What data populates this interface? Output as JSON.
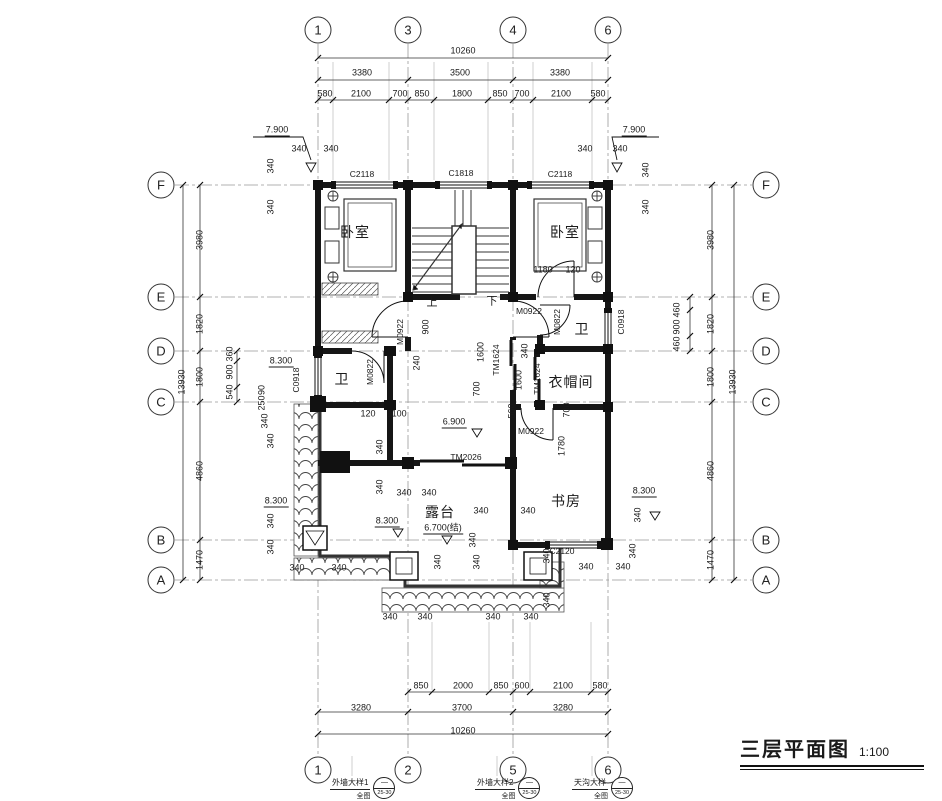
{
  "title": {
    "name": "三层平面图",
    "scale": "1:100"
  },
  "bubbles": {
    "top": [
      {
        "n": "1",
        "x": 318
      },
      {
        "n": "3",
        "x": 408
      },
      {
        "n": "4",
        "x": 513
      },
      {
        "n": "6",
        "x": 608
      }
    ],
    "bottom": [
      {
        "n": "1",
        "x": 318
      },
      {
        "n": "2",
        "x": 408
      },
      {
        "n": "5",
        "x": 513
      },
      {
        "n": "6",
        "x": 608
      }
    ],
    "left": [
      {
        "n": "F",
        "y": 185
      },
      {
        "n": "E",
        "y": 297
      },
      {
        "n": "D",
        "y": 351
      },
      {
        "n": "C",
        "y": 402
      },
      {
        "n": "B",
        "y": 540
      },
      {
        "n": "A",
        "y": 580
      }
    ],
    "right": [
      {
        "n": "F",
        "y": 185
      },
      {
        "n": "E",
        "y": 297
      },
      {
        "n": "D",
        "y": 351
      },
      {
        "n": "C",
        "y": 402
      },
      {
        "n": "B",
        "y": 540
      },
      {
        "n": "A",
        "y": 580
      }
    ]
  },
  "callouts": [
    {
      "label": "外墙大样1",
      "sub": "全图",
      "circle_top": "—",
      "circle_bottom": "25-30",
      "x": 330
    },
    {
      "label": "外墙大样2",
      "sub": "全图",
      "circle_top": "—",
      "circle_bottom": "25-30",
      "x": 475
    },
    {
      "label": "天沟大样",
      "sub": "全图",
      "circle_top": "—",
      "circle_bottom": "25-30",
      "x": 572
    }
  ],
  "annotations": [
    {
      "t": "10260",
      "x": 463,
      "y": 51
    },
    {
      "t": "3380",
      "x": 362,
      "y": 73
    },
    {
      "t": "3500",
      "x": 460,
      "y": 73
    },
    {
      "t": "3380",
      "x": 560,
      "y": 73
    },
    {
      "t": "580",
      "x": 325,
      "y": 94
    },
    {
      "t": "2100",
      "x": 361,
      "y": 94
    },
    {
      "t": "700",
      "x": 400,
      "y": 94
    },
    {
      "t": "850",
      "x": 422,
      "y": 94
    },
    {
      "t": "1800",
      "x": 462,
      "y": 94
    },
    {
      "t": "850",
      "x": 500,
      "y": 94
    },
    {
      "t": "700",
      "x": 522,
      "y": 94
    },
    {
      "t": "2100",
      "x": 561,
      "y": 94
    },
    {
      "t": "580",
      "x": 598,
      "y": 94
    },
    {
      "t": "7.900",
      "x": 277,
      "y": 131,
      "cls": "lvl"
    },
    {
      "t": "7.900",
      "x": 634,
      "y": 131,
      "cls": "lvl"
    },
    {
      "t": "340",
      "x": 299,
      "y": 149
    },
    {
      "t": "340",
      "x": 331,
      "y": 149
    },
    {
      "t": "340",
      "x": 585,
      "y": 149
    },
    {
      "t": "340",
      "x": 620,
      "y": 149
    },
    {
      "t": "340",
      "x": 271,
      "y": 166,
      "rot": 1
    },
    {
      "t": "340",
      "x": 271,
      "y": 207,
      "rot": 1
    },
    {
      "t": "340",
      "x": 646,
      "y": 170,
      "rot": 1
    },
    {
      "t": "340",
      "x": 646,
      "y": 207,
      "rot": 1
    },
    {
      "t": "C2118",
      "x": 362,
      "y": 174,
      "cls": "tag"
    },
    {
      "t": "C1818",
      "x": 461,
      "y": 173,
      "cls": "tag"
    },
    {
      "t": "C2118",
      "x": 560,
      "y": 174,
      "cls": "tag"
    },
    {
      "t": "3980",
      "x": 200,
      "y": 240,
      "rot": 1
    },
    {
      "t": "1820",
      "x": 200,
      "y": 324,
      "rot": 1
    },
    {
      "t": "1800",
      "x": 200,
      "y": 377,
      "rot": 1
    },
    {
      "t": "4860",
      "x": 200,
      "y": 471,
      "rot": 1
    },
    {
      "t": "1470",
      "x": 200,
      "y": 560,
      "rot": 1
    },
    {
      "t": "13930",
      "x": 182,
      "y": 382,
      "rot": 1
    },
    {
      "t": "360",
      "x": 230,
      "y": 354,
      "rot": 1
    },
    {
      "t": "900",
      "x": 230,
      "y": 372,
      "rot": 1
    },
    {
      "t": "540",
      "x": 230,
      "y": 392,
      "rot": 1
    },
    {
      "t": "8.300",
      "x": 281,
      "y": 362,
      "cls": "lvl"
    },
    {
      "t": "C0918",
      "x": 296,
      "y": 380,
      "rot": 1,
      "cls": "tag"
    },
    {
      "t": "90",
      "x": 262,
      "y": 390,
      "rot": 1
    },
    {
      "t": "250",
      "x": 262,
      "y": 403,
      "rot": 1
    },
    {
      "t": "340",
      "x": 265,
      "y": 421,
      "rot": 1
    },
    {
      "t": "340",
      "x": 271,
      "y": 441,
      "rot": 1
    },
    {
      "t": "8.300",
      "x": 276,
      "y": 502,
      "cls": "lvl"
    },
    {
      "t": "340",
      "x": 271,
      "y": 521,
      "rot": 1
    },
    {
      "t": "340",
      "x": 271,
      "y": 547,
      "rot": 1
    },
    {
      "t": "340",
      "x": 297,
      "y": 568
    },
    {
      "t": "340",
      "x": 339,
      "y": 568
    },
    {
      "t": "3980",
      "x": 711,
      "y": 240,
      "rot": 1
    },
    {
      "t": "1820",
      "x": 711,
      "y": 324,
      "rot": 1
    },
    {
      "t": "1800",
      "x": 711,
      "y": 377,
      "rot": 1
    },
    {
      "t": "4860",
      "x": 711,
      "y": 471,
      "rot": 1
    },
    {
      "t": "1470",
      "x": 711,
      "y": 560,
      "rot": 1
    },
    {
      "t": "13930",
      "x": 733,
      "y": 382,
      "rot": 1
    },
    {
      "t": "460",
      "x": 677,
      "y": 310,
      "rot": 1
    },
    {
      "t": "900",
      "x": 677,
      "y": 327,
      "rot": 1
    },
    {
      "t": "460",
      "x": 677,
      "y": 344,
      "rot": 1
    },
    {
      "t": "C0918",
      "x": 621,
      "y": 322,
      "rot": 1,
      "cls": "tag"
    },
    {
      "t": "8.300",
      "x": 644,
      "y": 492,
      "cls": "lvl"
    },
    {
      "t": "340",
      "x": 638,
      "y": 515,
      "rot": 1
    },
    {
      "t": "340",
      "x": 633,
      "y": 551,
      "rot": 1
    },
    {
      "t": "340",
      "x": 586,
      "y": 567
    },
    {
      "t": "340",
      "x": 623,
      "y": 567
    },
    {
      "t": "卧室",
      "x": 355,
      "y": 232,
      "cls": "room"
    },
    {
      "t": "卧室",
      "x": 565,
      "y": 232,
      "cls": "room"
    },
    {
      "t": "1180",
      "x": 543,
      "y": 270
    },
    {
      "t": "120",
      "x": 573,
      "y": 270
    },
    {
      "t": "上",
      "x": 432,
      "y": 303,
      "cls": "stair"
    },
    {
      "t": "下",
      "x": 492,
      "y": 302,
      "cls": "stair"
    },
    {
      "t": "M0922",
      "x": 400,
      "y": 332,
      "rot": 1,
      "cls": "tag"
    },
    {
      "t": "900",
      "x": 426,
      "y": 327,
      "rot": 1
    },
    {
      "t": "240",
      "x": 417,
      "y": 363,
      "rot": 1
    },
    {
      "t": "M0922",
      "x": 529,
      "y": 311,
      "cls": "tag"
    },
    {
      "t": "M0822",
      "x": 557,
      "y": 322,
      "rot": 1,
      "cls": "tag"
    },
    {
      "t": "卫",
      "x": 582,
      "y": 329,
      "cls": "room"
    },
    {
      "t": "卫",
      "x": 342,
      "y": 379,
      "cls": "room"
    },
    {
      "t": "M0822",
      "x": 370,
      "y": 372,
      "rot": 1,
      "cls": "tag"
    },
    {
      "t": "衣帽间",
      "x": 571,
      "y": 382,
      "cls": "room"
    },
    {
      "t": "120",
      "x": 368,
      "y": 414
    },
    {
      "t": "1100",
      "x": 397,
      "y": 414
    },
    {
      "t": "TM1624",
      "x": 496,
      "y": 360,
      "rot": 1,
      "cls": "tag"
    },
    {
      "t": "1600",
      "x": 481,
      "y": 352,
      "rot": 1
    },
    {
      "t": "700",
      "x": 477,
      "y": 389,
      "rot": 1
    },
    {
      "t": "340",
      "x": 525,
      "y": 351,
      "rot": 1
    },
    {
      "t": "1600",
      "x": 519,
      "y": 380,
      "rot": 1
    },
    {
      "t": "560",
      "x": 512,
      "y": 411,
      "rot": 1
    },
    {
      "t": "TM1624",
      "x": 537,
      "y": 379,
      "rot": 1,
      "cls": "tag"
    },
    {
      "t": "700",
      "x": 567,
      "y": 410,
      "rot": 1
    },
    {
      "t": "M0922",
      "x": 531,
      "y": 431,
      "cls": "tag"
    },
    {
      "t": "1780",
      "x": 562,
      "y": 446,
      "rot": 1
    },
    {
      "t": "6.900",
      "x": 454,
      "y": 423,
      "cls": "lvl"
    },
    {
      "t": "TM2026",
      "x": 466,
      "y": 457,
      "cls": "tag"
    },
    {
      "t": "340",
      "x": 380,
      "y": 447,
      "rot": 1
    },
    {
      "t": "340",
      "x": 380,
      "y": 487,
      "rot": 1
    },
    {
      "t": "340",
      "x": 404,
      "y": 493
    },
    {
      "t": "340",
      "x": 429,
      "y": 493
    },
    {
      "t": "露台",
      "x": 440,
      "y": 512,
      "cls": "room"
    },
    {
      "t": "6.700(结)",
      "x": 443,
      "y": 529,
      "cls": "lvl"
    },
    {
      "t": "8.300",
      "x": 387,
      "y": 522,
      "cls": "lvl"
    },
    {
      "t": "书房",
      "x": 566,
      "y": 501,
      "cls": "room"
    },
    {
      "t": "340",
      "x": 481,
      "y": 511
    },
    {
      "t": "340",
      "x": 528,
      "y": 511
    },
    {
      "t": "340",
      "x": 473,
      "y": 540,
      "rot": 1
    },
    {
      "t": "C2120",
      "x": 562,
      "y": 551,
      "cls": "tag"
    },
    {
      "t": "340",
      "x": 547,
      "y": 556,
      "rot": 1
    },
    {
      "t": "340",
      "x": 547,
      "y": 600,
      "rot": 1
    },
    {
      "t": "340",
      "x": 390,
      "y": 617
    },
    {
      "t": "340",
      "x": 425,
      "y": 617
    },
    {
      "t": "340",
      "x": 493,
      "y": 617
    },
    {
      "t": "340",
      "x": 531,
      "y": 617
    },
    {
      "t": "340",
      "x": 438,
      "y": 562,
      "rot": 1
    },
    {
      "t": "340",
      "x": 477,
      "y": 562,
      "rot": 1
    },
    {
      "t": "850",
      "x": 421,
      "y": 686
    },
    {
      "t": "2000",
      "x": 463,
      "y": 686
    },
    {
      "t": "850",
      "x": 501,
      "y": 686
    },
    {
      "t": "600",
      "x": 522,
      "y": 686
    },
    {
      "t": "2100",
      "x": 563,
      "y": 686
    },
    {
      "t": "580",
      "x": 600,
      "y": 686
    },
    {
      "t": "3280",
      "x": 361,
      "y": 708
    },
    {
      "t": "3700",
      "x": 462,
      "y": 708
    },
    {
      "t": "3280",
      "x": 563,
      "y": 708
    },
    {
      "t": "10260",
      "x": 463,
      "y": 731
    }
  ]
}
